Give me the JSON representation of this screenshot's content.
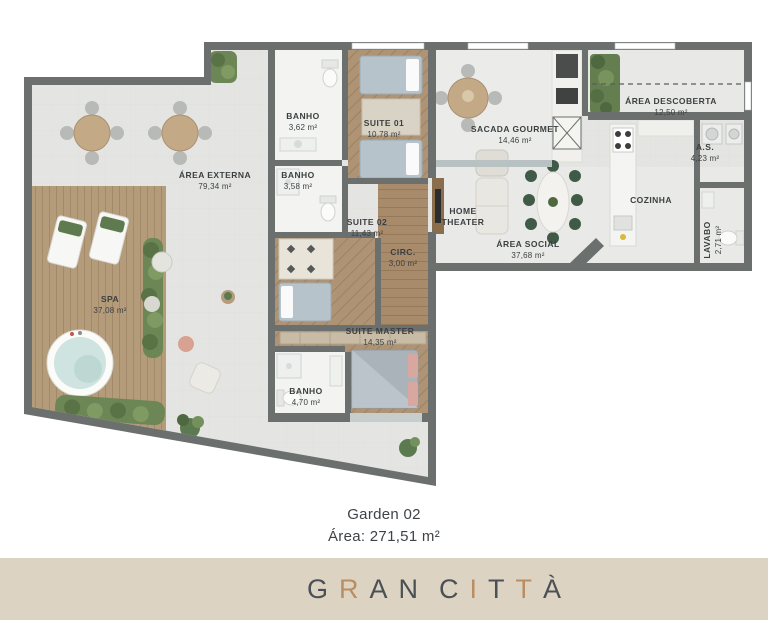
{
  "plan": {
    "rooms": [
      {
        "name": "ÁREA EXTERNA",
        "area": "79,34 m²"
      },
      {
        "name": "SPA",
        "area": "37,08 m²"
      },
      {
        "name": "BANHO",
        "area": "3,62 m²"
      },
      {
        "name": "SUITE 01",
        "area": "10,78 m²"
      },
      {
        "name": "BANHO",
        "area": "3,58 m²"
      },
      {
        "name": "SUITE 02",
        "area": "11,43 m²"
      },
      {
        "name": "CIRC.",
        "area": "3,00 m²"
      },
      {
        "name": "SUITE MASTER",
        "area": "14,35 m²"
      },
      {
        "name": "BANHO",
        "area": "4,70 m²"
      },
      {
        "name": "SACADA GOURMET",
        "area": "14,46 m²"
      },
      {
        "name": "HOME",
        "name2": "THEATER"
      },
      {
        "name": "ÁREA SOCIAL",
        "area": "37,68 m²"
      },
      {
        "name": "ÁREA DESCOBERTA",
        "area": "12,50 m²"
      },
      {
        "name": "A.S.",
        "area": "4,23 m²"
      },
      {
        "name": "COZINHA"
      },
      {
        "name": "LAVABO",
        "area": "2,71 m²"
      }
    ]
  },
  "caption": {
    "unit": "Garden 02",
    "area": "Área: 271,51 m²"
  },
  "footer": {
    "brand": "GRAN CITTÀ",
    "letters": [
      {
        "ch": "G",
        "tone": "dark"
      },
      {
        "ch": "R",
        "tone": "bronze"
      },
      {
        "ch": "A",
        "tone": "dark"
      },
      {
        "ch": "N",
        "tone": "dark"
      },
      {
        "ch": " ",
        "tone": "space"
      },
      {
        "ch": "C",
        "tone": "dark"
      },
      {
        "ch": "I",
        "tone": "bronze"
      },
      {
        "ch": "T",
        "tone": "dark"
      },
      {
        "ch": "T",
        "tone": "bronze"
      },
      {
        "ch": "À",
        "tone": "dark"
      }
    ]
  },
  "colors": {
    "wall": "#6b6f6e",
    "tile": "#e4e5e2",
    "deck_wood": "#b49b7a",
    "suite_wood": "#ae9374",
    "footer_band": "#ddd3c2",
    "brand_dark": "#4b5054",
    "brand_bronze": "#b98e63",
    "greenery": "#6d8656",
    "water": "#cfe3e0"
  }
}
